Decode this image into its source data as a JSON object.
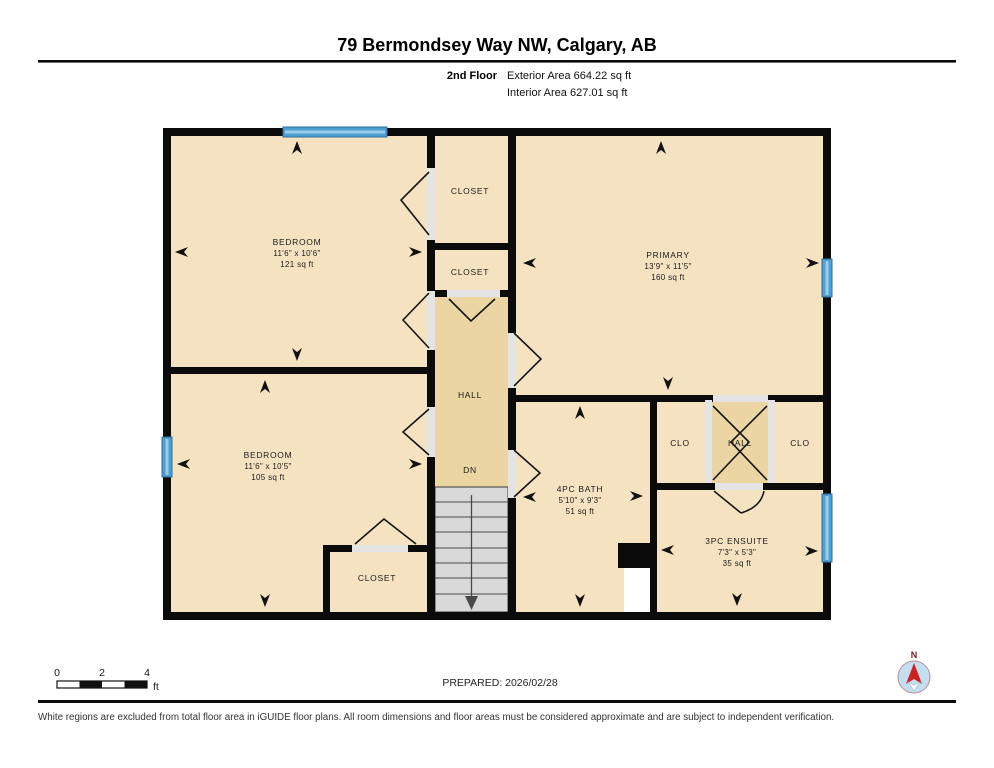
{
  "header": {
    "title": "79 Bermondsey Way NW, Calgary, AB",
    "floor_label": "2nd Floor",
    "exterior_area": "Exterior Area 664.22 sq ft",
    "interior_area": "Interior Area 627.01 sq ft"
  },
  "rooms": {
    "bedroom1": {
      "name": "BEDROOM",
      "dims": "11'6\" x 10'6\"",
      "area": "121 sq ft"
    },
    "closet_top": {
      "name": "CLOSET"
    },
    "closet_mid": {
      "name": "CLOSET"
    },
    "primary": {
      "name": "PRIMARY",
      "dims": "13'9\" x 11'5\"",
      "area": "160 sq ft"
    },
    "bedroom2": {
      "name": "BEDROOM",
      "dims": "11'6\" x 10'5\"",
      "area": "105 sq ft"
    },
    "hall": {
      "name": "HALL",
      "dn_label": "DN"
    },
    "bath": {
      "name": "4PC BATH",
      "dims": "5'10\" x 9'3\"",
      "area": "51 sq ft"
    },
    "clo_left": {
      "name": "CLO"
    },
    "hall_small": {
      "name": "HALL"
    },
    "clo_right": {
      "name": "CLO"
    },
    "ensuite": {
      "name": "3PC ENSUITE",
      "dims": "7'3\" x 5'3\"",
      "area": "35 sq ft"
    },
    "closet_bottom": {
      "name": "CLOSET"
    }
  },
  "footer": {
    "scale": {
      "ticks": [
        "0",
        "2",
        "4"
      ],
      "unit": "ft"
    },
    "prepared": "PREPARED: 2026/02/28",
    "disclaimer": "White regions are excluded from total floor area in iGUIDE floor plans. All room dimensions and floor areas must be considered approximate and are subject to independent verification."
  },
  "compass": {
    "north_label": "N"
  },
  "colors": {
    "room_fill": "#f5e2c1",
    "hall_fill": "#ebd5a3",
    "wall": "#0b0b0b",
    "door_gap": "#e4e4e4",
    "window_blue": "#4d9fd3",
    "window_blue_light": "#9ccbe8",
    "stairs_fill": "#d9d9d9",
    "compass_fill": "#c3def0",
    "compass_needle": "#cc2222"
  }
}
